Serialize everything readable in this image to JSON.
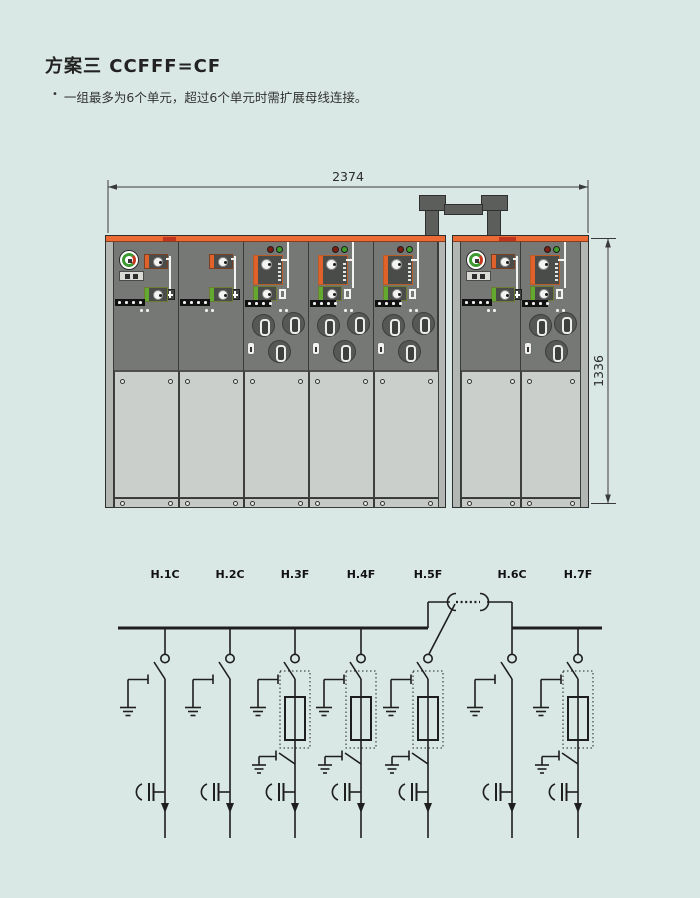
{
  "page": {
    "title": "方案三  CCFFF=CF",
    "bullet_marker": "•",
    "bullet_text": "一组最多为6个单元，超过6个单元时需扩展母线连接。"
  },
  "drawing": {
    "width_dimension": "2374",
    "height_dimension": "1336",
    "group1_unit_count": 5,
    "group2_unit_count": 2
  },
  "circuit": {
    "feeders": [
      {
        "label": "H.1C",
        "type": "C"
      },
      {
        "label": "H.2C",
        "type": "C"
      },
      {
        "label": "H.3F",
        "type": "F"
      },
      {
        "label": "H.4F",
        "type": "F"
      },
      {
        "label": "H.5F",
        "type": "F"
      },
      {
        "label": "H.6C",
        "type": "C"
      },
      {
        "label": "H.7F",
        "type": "F"
      }
    ]
  },
  "colors": {
    "page_background": "#d9e8e4",
    "cabinet_orange_strip": "#ec6b35",
    "cabinet_body_gray": "#767876",
    "door_panel_gray": "#cbcfcb",
    "busbar_bridge_gray": "#5c5e5c",
    "module_tag_orange": "#e0622a",
    "module_tag_green": "#63a930",
    "led_red": "#7c1d10",
    "led_green": "#3f9e28",
    "schematic_line": "#1e1e1e"
  }
}
